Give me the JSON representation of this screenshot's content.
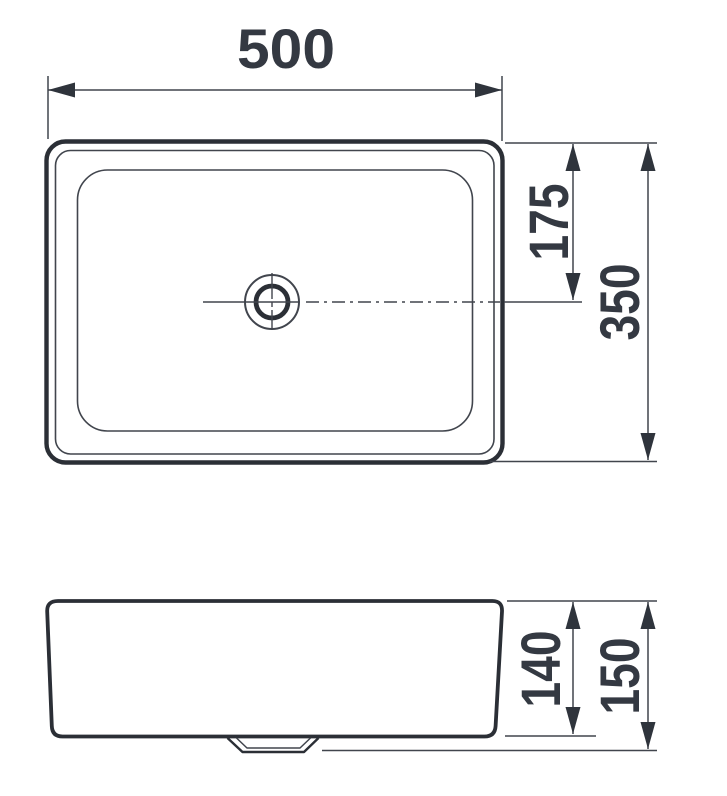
{
  "drawing": {
    "kind": "washbasin-dimension-drawing",
    "views": {
      "plan": "rectangular basin with centered drain",
      "elevation": "basin side profile with drain outlet"
    }
  },
  "dimensions": {
    "width": "500",
    "drain_offset": "175",
    "depth": "350",
    "body_height": "140",
    "overall_height": "150"
  },
  "colors": {
    "line_thick": "#2b2f36",
    "line_thin": "#41454d",
    "text": "#343942",
    "background": "#ffffff"
  }
}
